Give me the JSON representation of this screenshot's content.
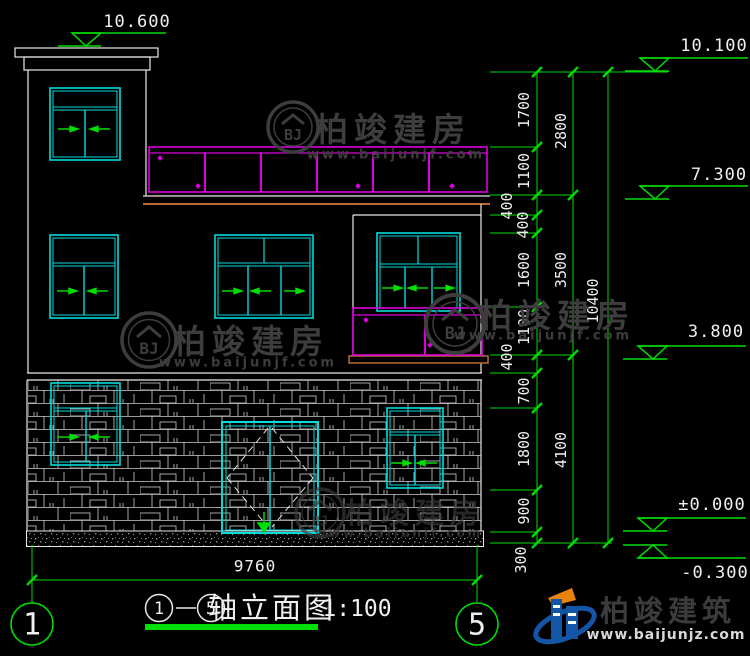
{
  "drawing": {
    "title": {
      "axis_start": "1",
      "axis_end": "5",
      "name": "轴立面图",
      "scale": "1:100"
    },
    "axis_bubbles": {
      "left": "1",
      "right": "5"
    },
    "elevations": {
      "parapet_top": "10.600",
      "roof": "10.100",
      "floor3": "7.300",
      "floor2": "3.800",
      "ground": "±0.000",
      "base": "-0.300"
    },
    "dims": {
      "overall_width": "9760",
      "chain_inner": [
        "1700",
        "1100",
        "400",
        "400",
        "1600",
        "1100",
        "400",
        "700",
        "1800",
        "900",
        "300"
      ],
      "chain_middle": [
        "2800",
        "3500",
        "4100"
      ],
      "chain_outer": [
        "10400"
      ]
    }
  },
  "watermark": {
    "name": "柏竣建房",
    "url": "www.baijunjf.com",
    "monogram": "BJ"
  },
  "brand": {
    "name": "柏竣建筑",
    "url": "www.baijunjz.com"
  },
  "colors": {
    "background": "#000000",
    "outline": "#e8e8e8",
    "window": "#00dcdc",
    "railing": "#dd00dd",
    "dimension": "#00dd00",
    "sill": "#b96a35"
  }
}
